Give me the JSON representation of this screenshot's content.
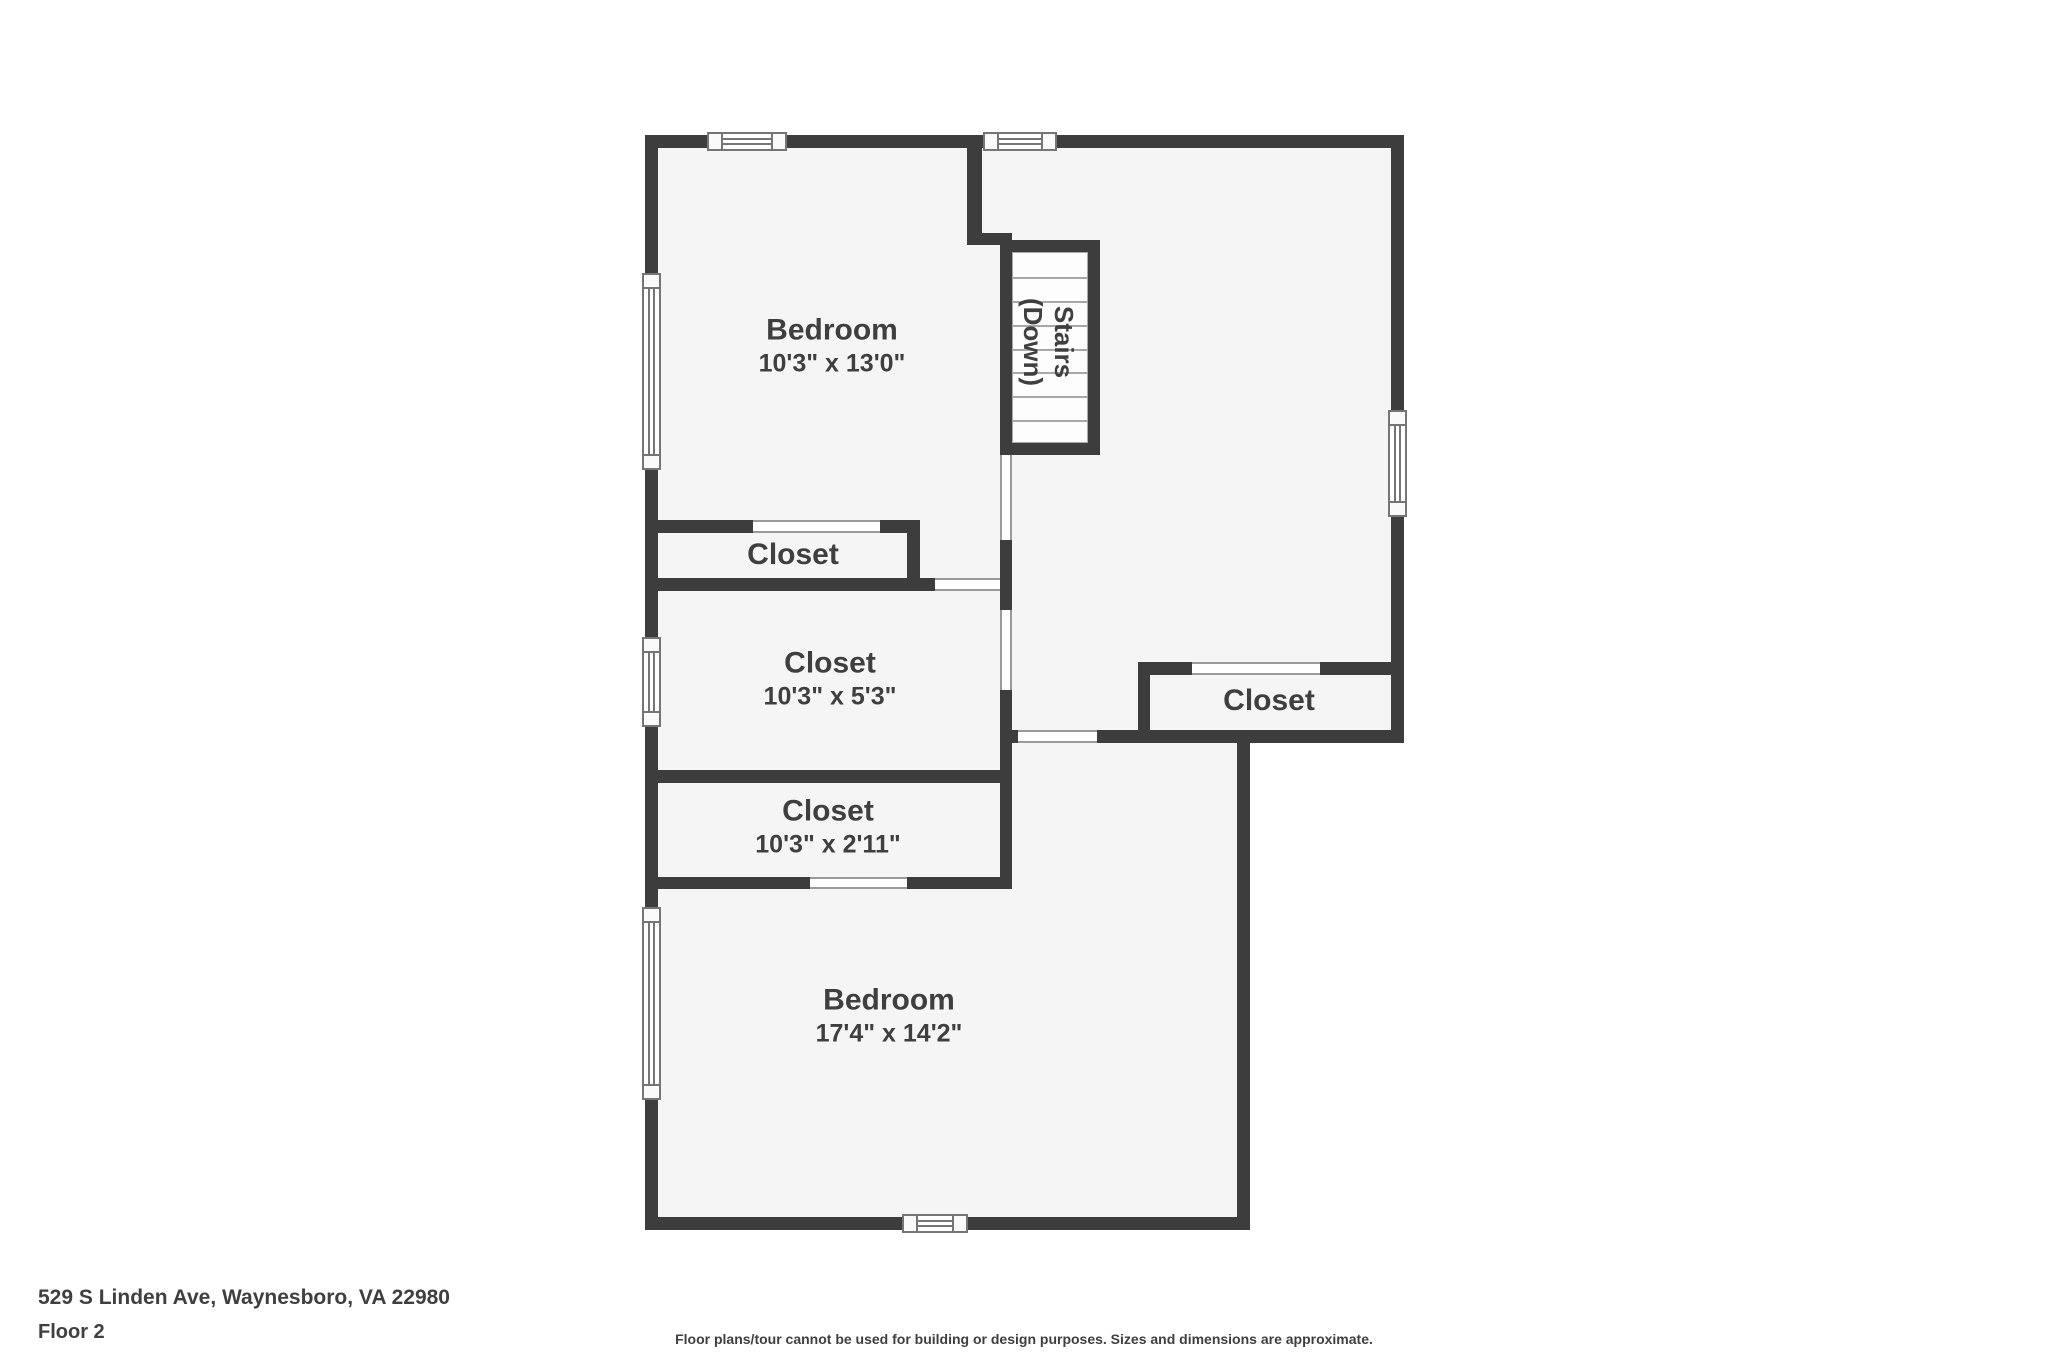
{
  "palette": {
    "wall": "#3d3d3d",
    "floor": "#f5f5f5",
    "background": "#ffffff",
    "text": "#3f3f3f",
    "window_line": "#757575",
    "tread_line": "#a8a8a8"
  },
  "rooms": {
    "bedroom_upper": {
      "label": "Bedroom",
      "dims": "10'3\" x 13'0\""
    },
    "stairs": {
      "label": "Stairs",
      "sublabel": "(Down)"
    },
    "closet_small": {
      "label": "Closet"
    },
    "closet_mid": {
      "label": "Closet",
      "dims": "10'3\" x 5'3\""
    },
    "closet_right": {
      "label": "Closet"
    },
    "closet_lower": {
      "label": "Closet",
      "dims": "10'3\" x 2'11\""
    },
    "bedroom_lower": {
      "label": "Bedroom",
      "dims": "17'4\" x 14'2\""
    }
  },
  "footer": {
    "address": "529 S Linden Ave, Waynesboro, VA 22980",
    "floor_label": "Floor 2",
    "disclaimer": "Floor plans/tour cannot be used for building or design purposes. Sizes and dimensions are approximate."
  }
}
